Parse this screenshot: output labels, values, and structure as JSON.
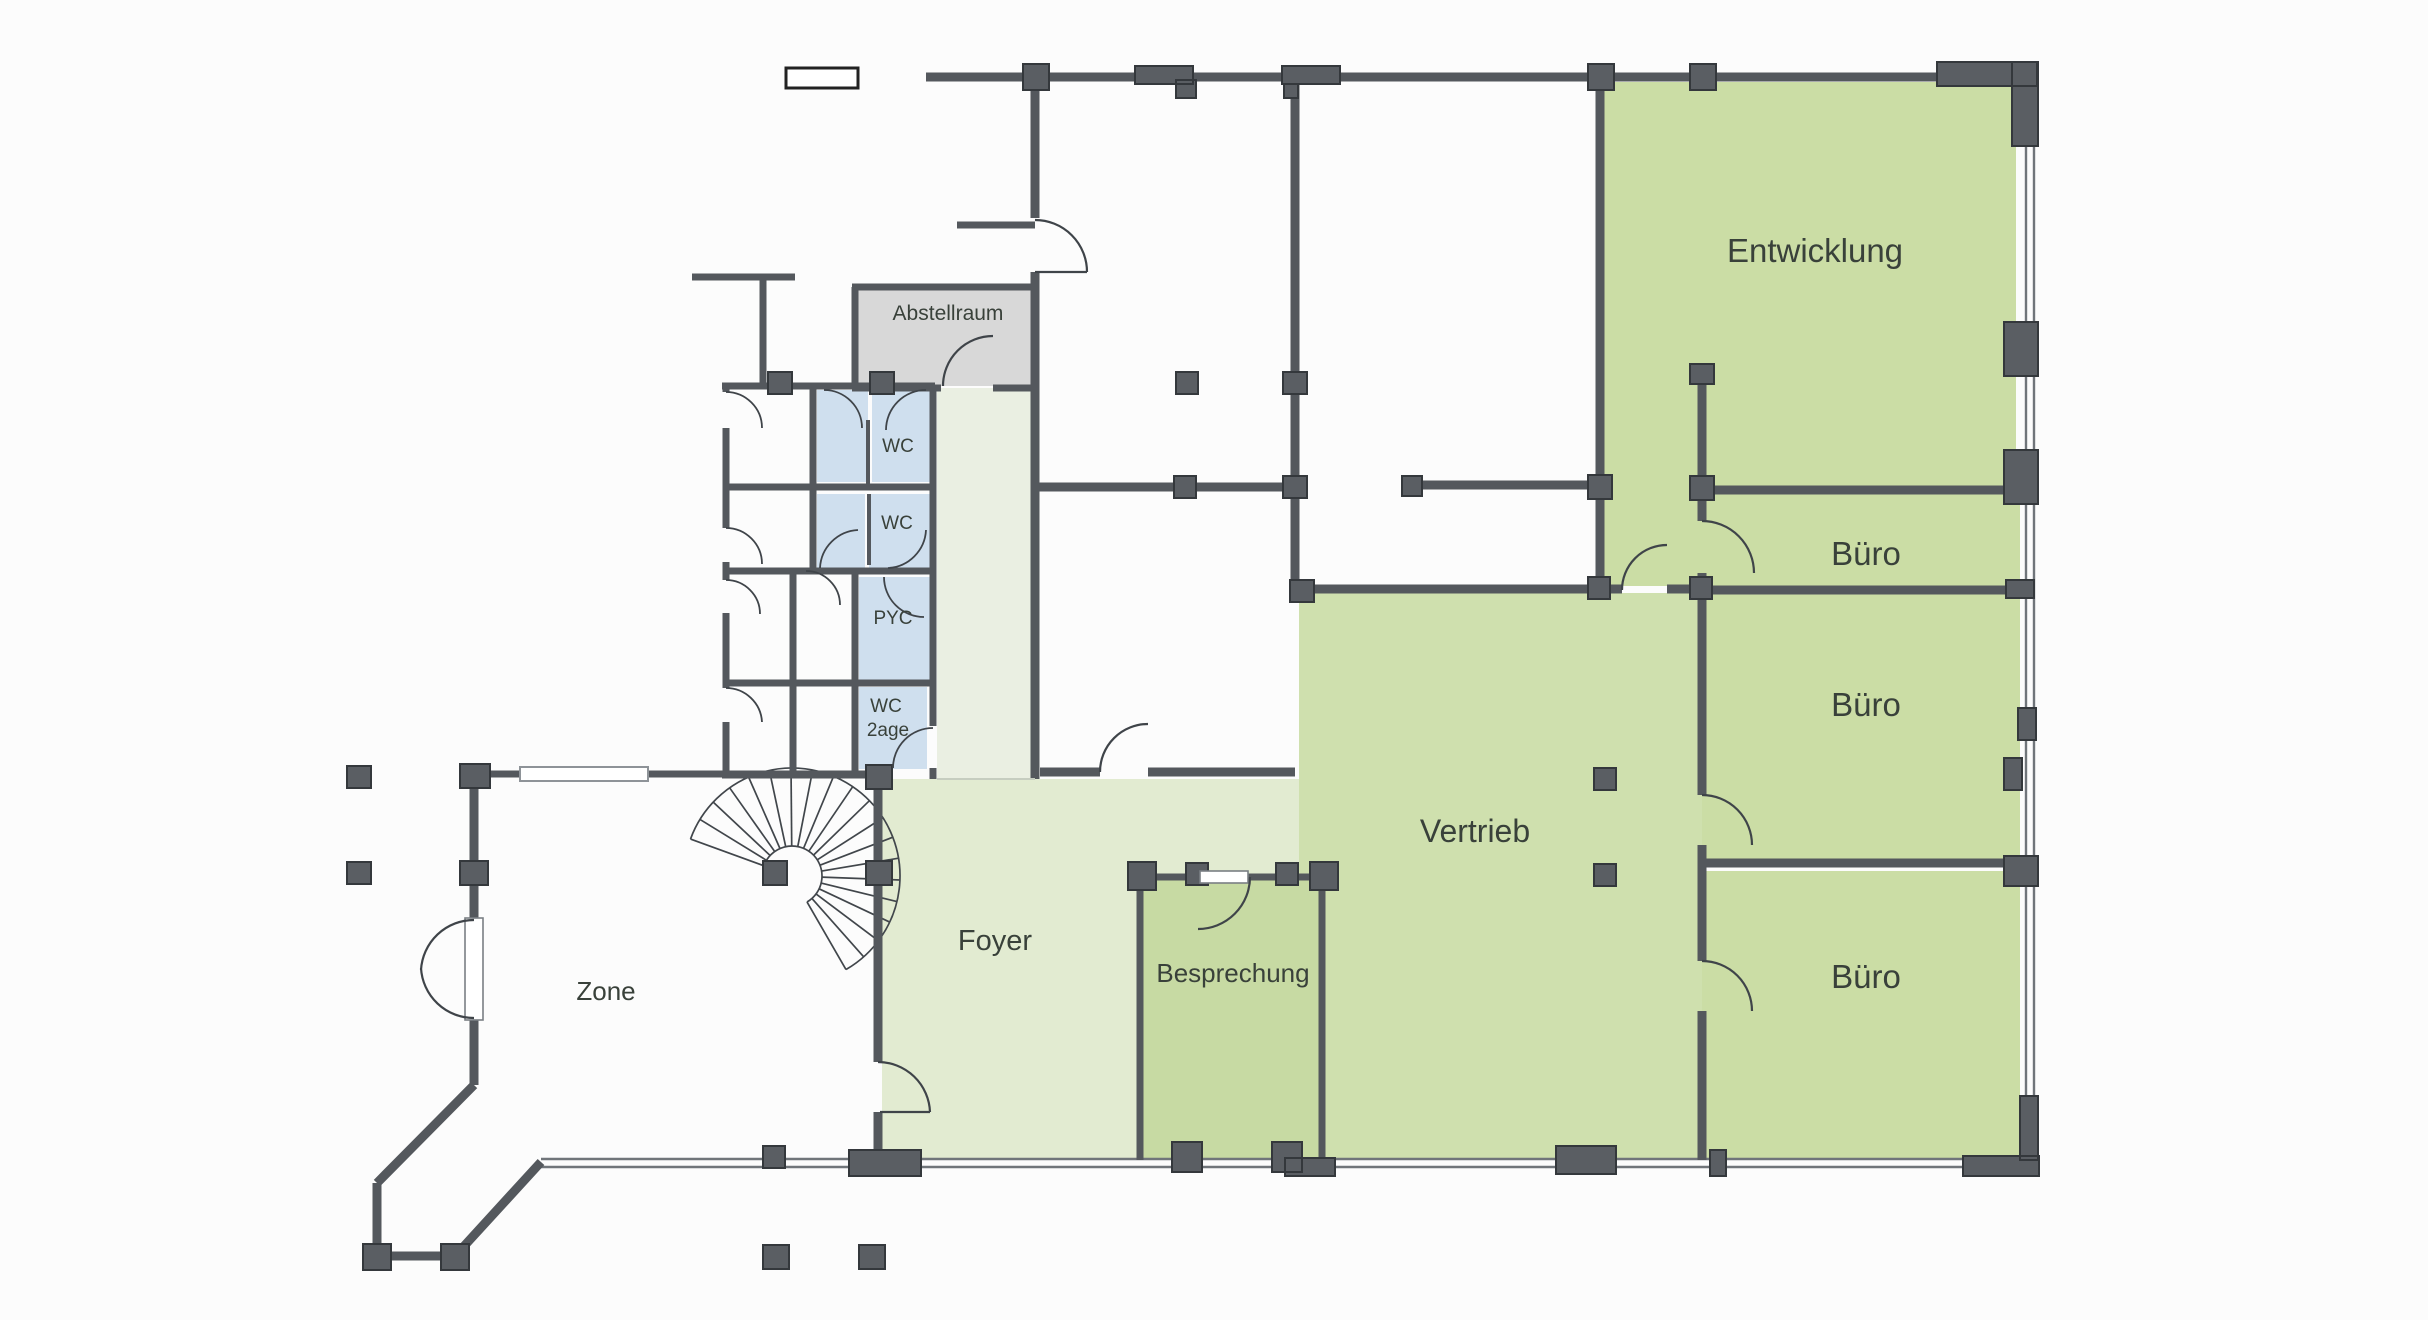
{
  "labels": {
    "entwicklung": "Entwicklung",
    "buero_top": "Büro",
    "buero_middle": "Büro",
    "buero_bottom": "Büro",
    "vertrieb": "Vertrieb",
    "besprechung": "Besprechung",
    "foyer": "Foyer",
    "zone": "Zone",
    "abstellraum": "Abstellraum",
    "wc_1": "WC",
    "wc_2": "WC",
    "pyc": "PYC",
    "wc_lounge_line1": "WC",
    "wc_lounge_line2": "2age"
  },
  "colors": {
    "background": "#fcfcfc",
    "wall": "#54585d",
    "block_fill": "#5a5e63",
    "block_border": "#34383c",
    "room_green": "#cbdda5",
    "vertrieb_green": "#cfe0ae",
    "besprechung_green": "#c7daa3",
    "foyer_green": "#e2ebd1",
    "corridor_green": "#eaefe2",
    "wet_room_blue": "#cfdfee",
    "storage_gray": "#d8d8d8",
    "door_line": "#3f4449",
    "window_line": "#70757a",
    "label_text": "#39413a"
  }
}
